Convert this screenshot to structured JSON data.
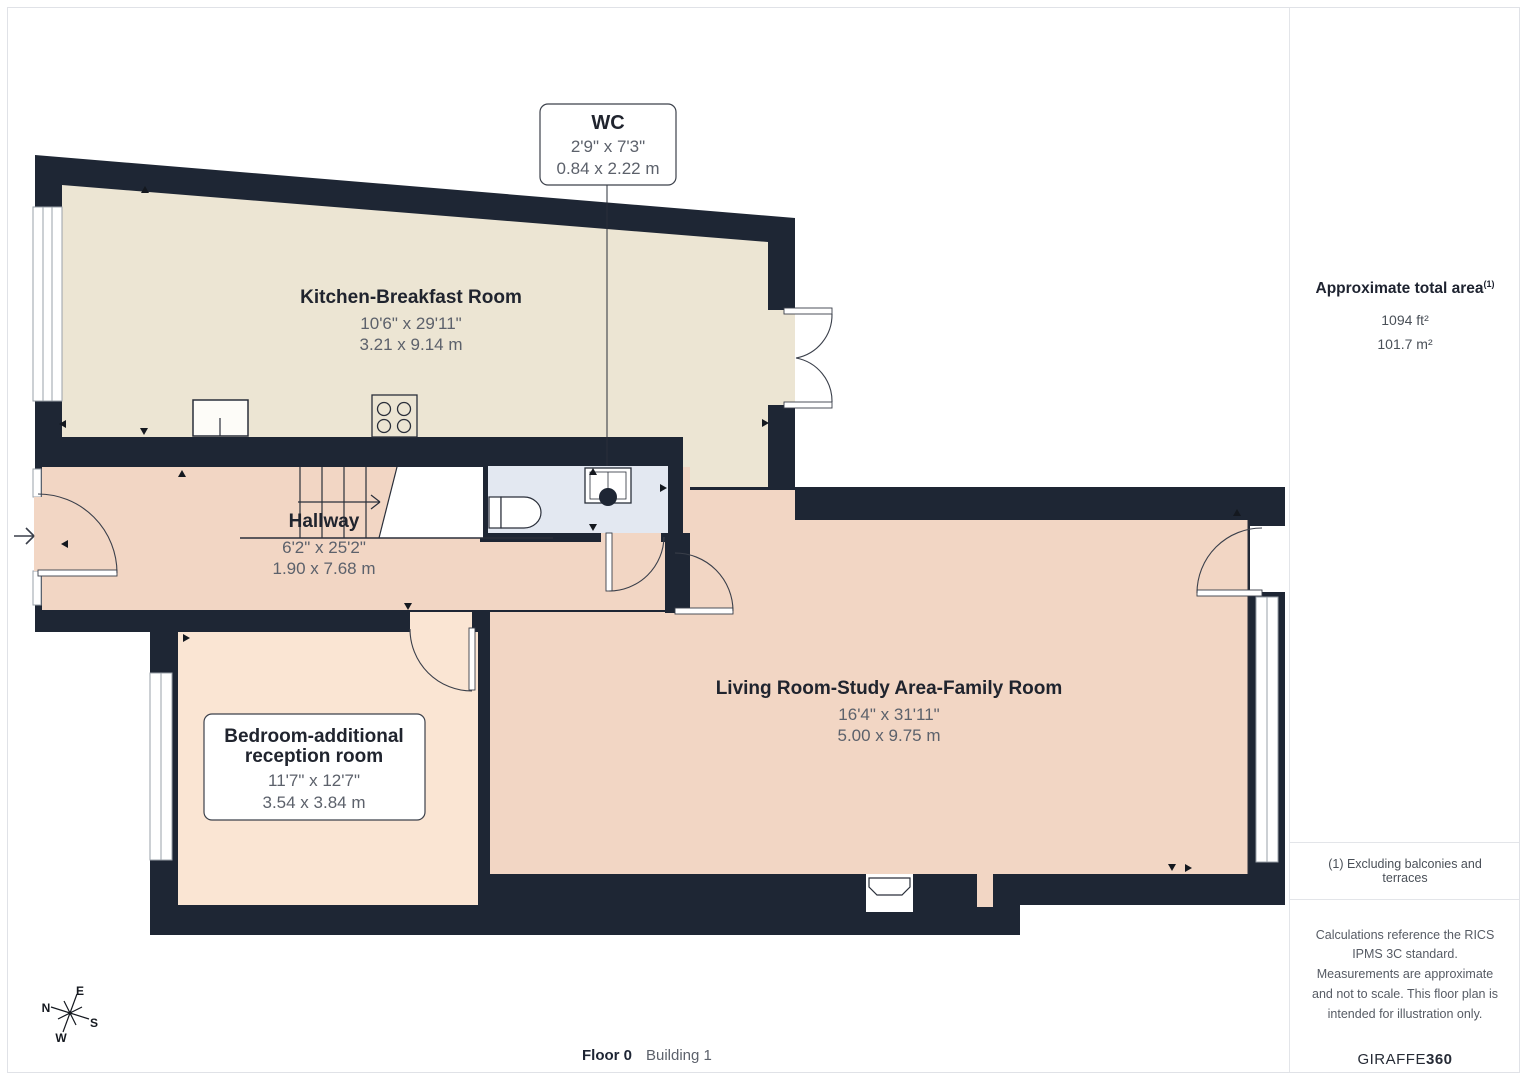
{
  "rooms": [
    {
      "id": "wc",
      "name": "WC",
      "imperial": "2'9\" x 7'3\"",
      "metric": "0.84 x 2.22 m"
    },
    {
      "id": "kitchen",
      "name": "Kitchen-Breakfast Room",
      "imperial": "10'6\" x 29'11\"",
      "metric": "3.21 x 9.14 m"
    },
    {
      "id": "hallway",
      "name": "Hallway",
      "imperial": "6'2\" x 25'2\"",
      "metric": "1.90 x 7.68 m"
    },
    {
      "id": "bedroom",
      "name_lines": [
        "Bedroom-additional",
        "reception room"
      ],
      "imperial": "11'7\" x 12'7\"",
      "metric": "3.54 x 3.84 m"
    },
    {
      "id": "living",
      "name": "Living Room-Study Area-Family Room",
      "imperial": "16'4\" x 31'11\"",
      "metric": "5.00 x 9.75 m"
    }
  ],
  "sidebar": {
    "total_area_label": "Approximate total area",
    "total_area_sup": "(1)",
    "area_ft": "1094 ft²",
    "area_m": "101.7 m²",
    "footnote": "(1) Excluding balconies and terraces",
    "disclaimer": "Calculations reference the RICS IPMS 3C standard. Measurements are approximate and not to scale. This floor plan is intended for illustration only.",
    "brand_regular": "GIRAFFE",
    "brand_bold": "360"
  },
  "footer": {
    "floor_label": "Floor 0",
    "building_label": "Building 1"
  },
  "compass": {
    "n": "N",
    "e": "E",
    "s": "S",
    "w": "W"
  },
  "colors": {
    "wall": "#1e2634",
    "kitchen_fill": "#ece5d3",
    "hallway_fill": "#f2d6c4",
    "living_fill": "#f2d6c4",
    "bedroom_fill": "#fae5d3",
    "wc_fill": "#e3e8f1",
    "title_text": "#20242e",
    "dim_text": "#5c616b"
  }
}
